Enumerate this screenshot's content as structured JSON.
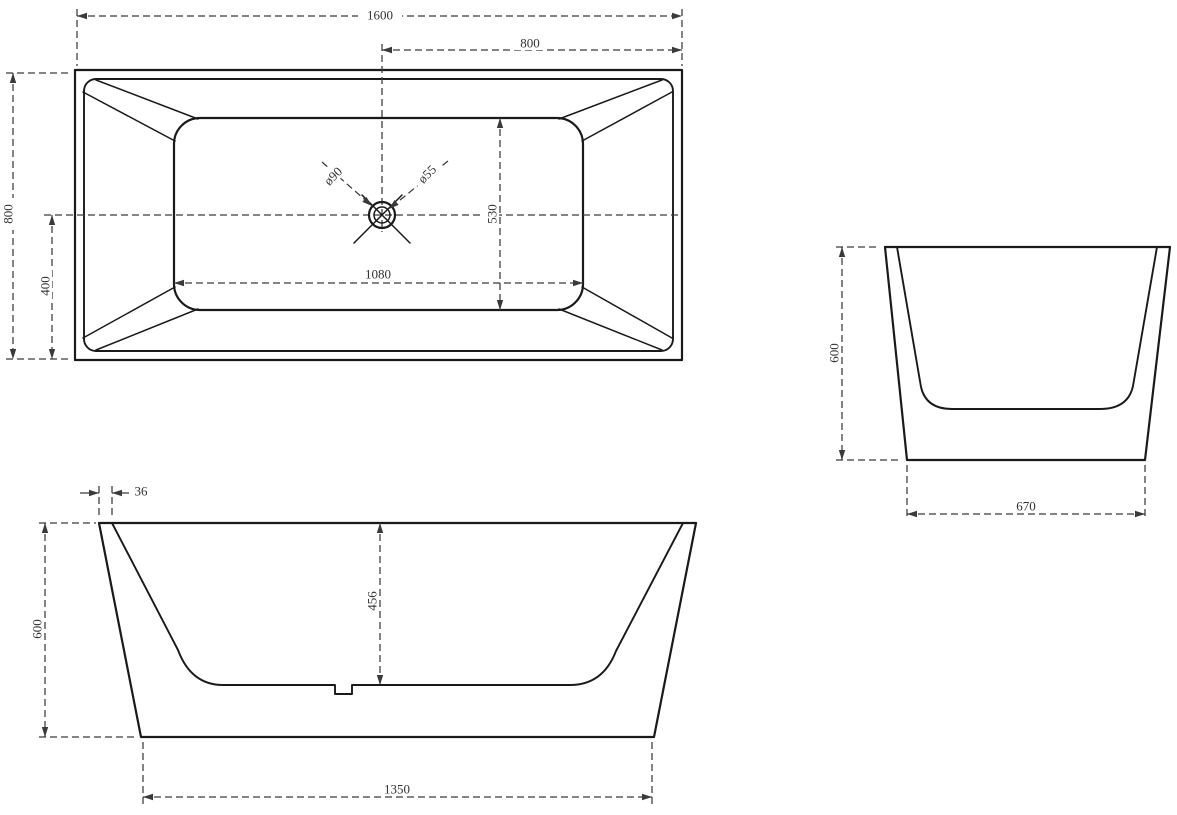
{
  "drawing": {
    "background_color": "#ffffff",
    "line_color": "#1a1a1a",
    "dimension_color": "#3a3a3a"
  },
  "dims": {
    "plan_length": "1600",
    "plan_drain_to_end": "800",
    "plan_width": "800",
    "plan_center_to_side": "400",
    "plan_basin_length": "1080",
    "plan_basin_width": "530",
    "drain_outer_dia": "ø90",
    "drain_inner_dia": "ø55",
    "side_height": "600",
    "side_base_width": "670",
    "front_rim_offset": "36",
    "front_height": "600",
    "front_inner_depth": "456",
    "front_base_length": "1350"
  }
}
